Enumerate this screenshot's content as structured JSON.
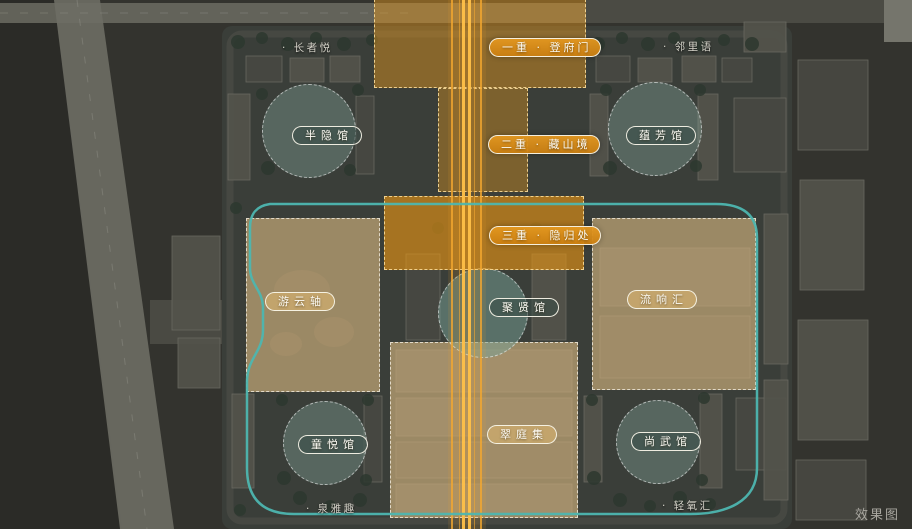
{
  "watermark": "效果图",
  "axis_gates": [
    {
      "label": "一重 · 登府门"
    },
    {
      "label": "二重 · 藏山境"
    },
    {
      "label": "三重 · 隐归处"
    }
  ],
  "halls": [
    {
      "label": "半隐馆"
    },
    {
      "label": "蕴芳馆"
    },
    {
      "label": "聚贤馆"
    },
    {
      "label": "童悦馆"
    },
    {
      "label": "尚武馆"
    }
  ],
  "landscape_zones": [
    {
      "label": "游云轴"
    },
    {
      "label": "流响汇"
    },
    {
      "label": "翠庭集"
    }
  ],
  "spot_labels": [
    {
      "label": "· 长者悦"
    },
    {
      "label": "· 邻里语"
    },
    {
      "label": "· 泉雅趣"
    },
    {
      "label": "· 轻氧汇"
    }
  ],
  "colors": {
    "axis_orange": "#f0a232",
    "tan_zone": "#cdb384",
    "teal_loop": "#4db6b0",
    "pad_green": "#809e94"
  }
}
